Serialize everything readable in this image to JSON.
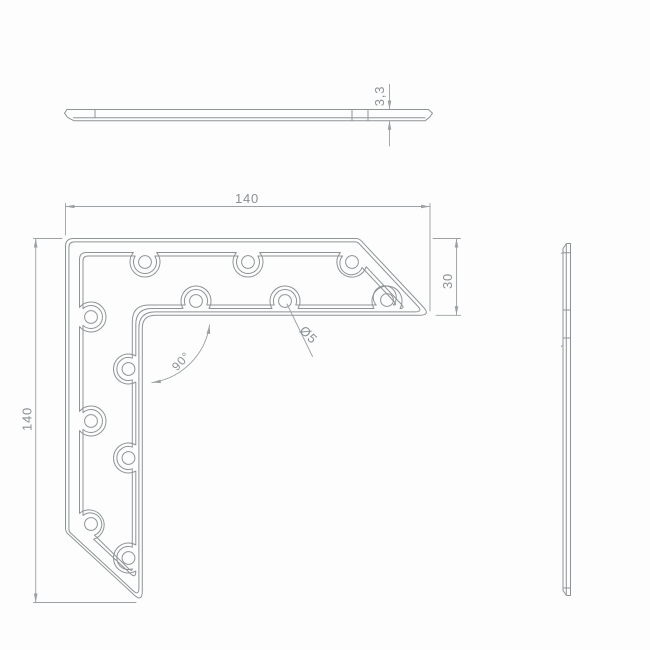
{
  "drawing": {
    "dimensions": {
      "overall_width": "140",
      "overall_height": "140",
      "leg_width": "30",
      "thickness": "3,3",
      "angle": "90°",
      "hole_diameter": "Ø5"
    },
    "holes": {
      "radius_px": 6.4,
      "centers": [
        [
          145,
          262
        ],
        [
          248,
          262
        ],
        [
          352,
          262
        ],
        [
          196,
          301
        ],
        [
          285,
          301
        ],
        [
          387,
          300
        ],
        [
          91,
          317
        ],
        [
          91,
          421
        ],
        [
          91,
          524
        ],
        [
          128.5,
          369
        ],
        [
          128.5,
          458
        ],
        [
          128.5,
          558
        ]
      ]
    },
    "colors": {
      "part_line": "#8e9496",
      "dim_line": "#9aa0a4",
      "text": "#8a9094",
      "background": "#fdfdfd"
    }
  }
}
